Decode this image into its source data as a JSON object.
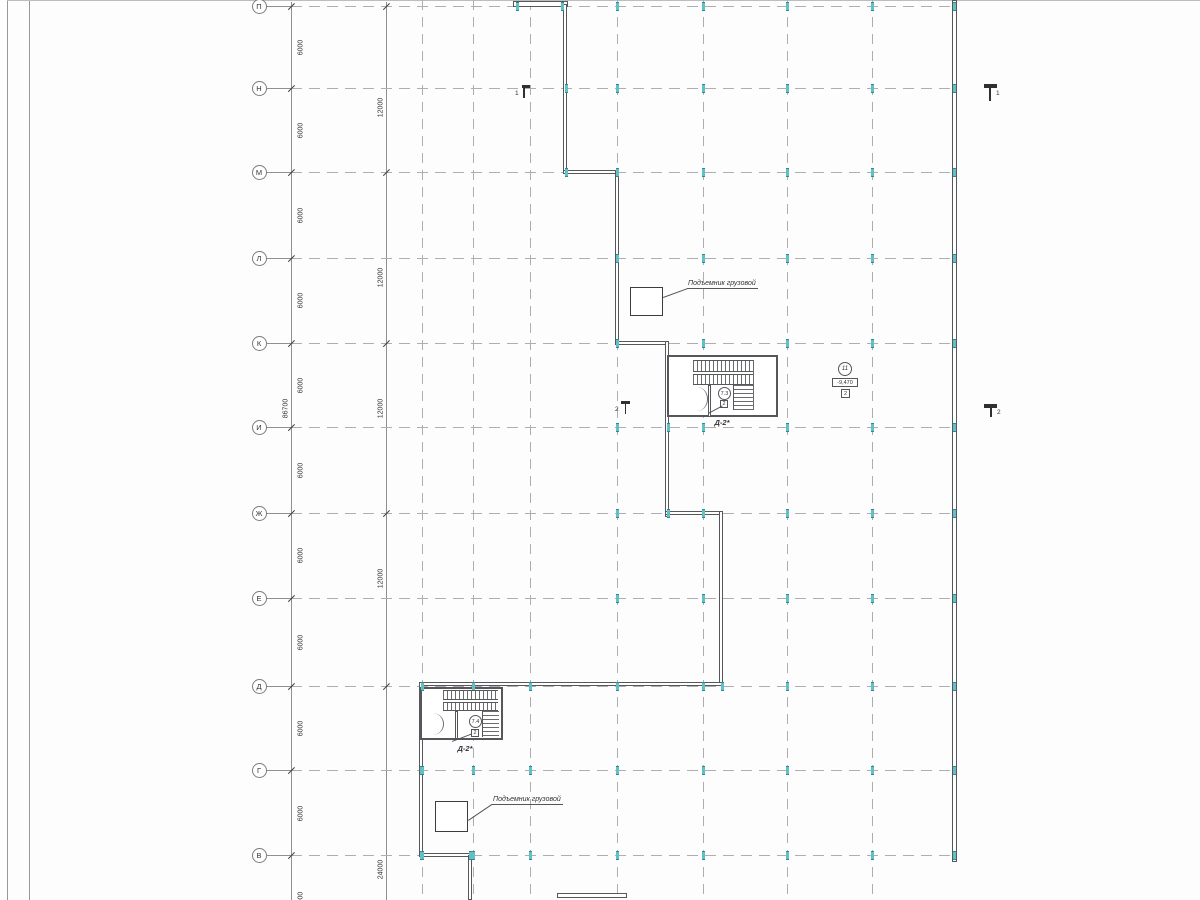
{
  "drawing": {
    "kind": "architectural-floor-plan",
    "language": "ru"
  },
  "colors": {
    "background": "#fdfdfd",
    "grid_dash": "#acaeb0",
    "wall": "#56575a",
    "dim_line": "#8f9092",
    "column_tick": "#62bfc4",
    "text": "#333436"
  },
  "axes": {
    "bubble_x": 259,
    "rows": [
      {
        "label": "П",
        "y": 6
      },
      {
        "label": "Н",
        "y": 88
      },
      {
        "label": "М",
        "y": 172
      },
      {
        "label": "Л",
        "y": 258
      },
      {
        "label": "К",
        "y": 343
      },
      {
        "label": "И",
        "y": 427
      },
      {
        "label": "Ж",
        "y": 513
      },
      {
        "label": "Е",
        "y": 598
      },
      {
        "label": "Д",
        "y": 686
      },
      {
        "label": "Г",
        "y": 770
      },
      {
        "label": "В",
        "y": 855
      }
    ],
    "row_line_x1": 291,
    "row_line_x2": 955,
    "columns_x": [
      422,
      473,
      530,
      617,
      703,
      787,
      872
    ],
    "grid_bottom": 900
  },
  "dimensions": {
    "line_a_x": 291,
    "line_b_x": 386,
    "chain_6000_x": 301,
    "chain_6000": [
      {
        "text": "6000",
        "y": 47
      },
      {
        "text": "6000",
        "y": 130
      },
      {
        "text": "6000",
        "y": 215
      },
      {
        "text": "6000",
        "y": 300
      },
      {
        "text": "6000",
        "y": 385
      },
      {
        "text": "6000",
        "y": 470
      },
      {
        "text": "6000",
        "y": 555
      },
      {
        "text": "6000",
        "y": 642
      },
      {
        "text": "6000",
        "y": 728
      },
      {
        "text": "6000",
        "y": 813
      },
      {
        "text": "6000",
        "y": 899
      }
    ],
    "chain_12000_x": 381,
    "chain_12000": [
      {
        "text": "12000",
        "y": 107
      },
      {
        "text": "12000",
        "y": 277
      },
      {
        "text": "12000",
        "y": 408
      },
      {
        "text": "12000",
        "y": 578
      },
      {
        "text": "24000",
        "y": 869
      }
    ],
    "chain_12000_ticks_y": [
      6,
      172,
      343,
      513,
      686
    ],
    "overall": {
      "text": "86700",
      "x": 286,
      "y": 408
    }
  },
  "walls": {
    "east_wall": [
      952,
      0,
      5,
      862
    ],
    "segments": [
      [
        513,
        1,
        55,
        6
      ],
      [
        563,
        4,
        4,
        170
      ],
      [
        563,
        170,
        56,
        4
      ],
      [
        615,
        170,
        4,
        175
      ],
      [
        615,
        341,
        54,
        4
      ],
      [
        665,
        341,
        4,
        176
      ],
      [
        665,
        511,
        58,
        4
      ],
      [
        719,
        511,
        4,
        175
      ],
      [
        419,
        682,
        304,
        4
      ],
      [
        419,
        682,
        4,
        175
      ],
      [
        419,
        853,
        53,
        4
      ],
      [
        468,
        855,
        4,
        45
      ],
      [
        557,
        893,
        70,
        5
      ]
    ],
    "stair_box_upper": [
      667,
      355,
      111,
      62
    ],
    "stair_box_lower": [
      420,
      687,
      83,
      53
    ]
  },
  "lifts": {
    "upper_box": [
      630,
      287,
      33,
      29
    ],
    "lower_box": [
      435,
      801,
      33,
      31
    ]
  },
  "ticks": {
    "right_cols": [
      617,
      703,
      787,
      872,
      954
    ],
    "left_cols": [
      422,
      473,
      530
    ],
    "left_rows_from": 8,
    "extras": [
      [
        517,
        6
      ],
      [
        562,
        6
      ],
      [
        566,
        88
      ],
      [
        566,
        172
      ],
      [
        668,
        427
      ],
      [
        668,
        513
      ],
      [
        722,
        686
      ],
      [
        421,
        770
      ],
      [
        421,
        855
      ],
      [
        470,
        855
      ]
    ]
  },
  "labels": {
    "lift_upper": "Подъемник грузовой",
    "lift_lower": "Подъемник грузовой",
    "stair_upper_tag": "Д-2*",
    "stair_lower_tag": "Д-2*",
    "stair_upper_num": "7.3",
    "stair_lower_num": "7.4",
    "stair_upper_door": "2",
    "stair_lower_door": "2",
    "room_num": "11",
    "elevation": "-9,470",
    "elevation_door": "2",
    "section_1_left": "1",
    "section_1_right": "1",
    "section_2_left": "2",
    "section_2_right": "2"
  }
}
